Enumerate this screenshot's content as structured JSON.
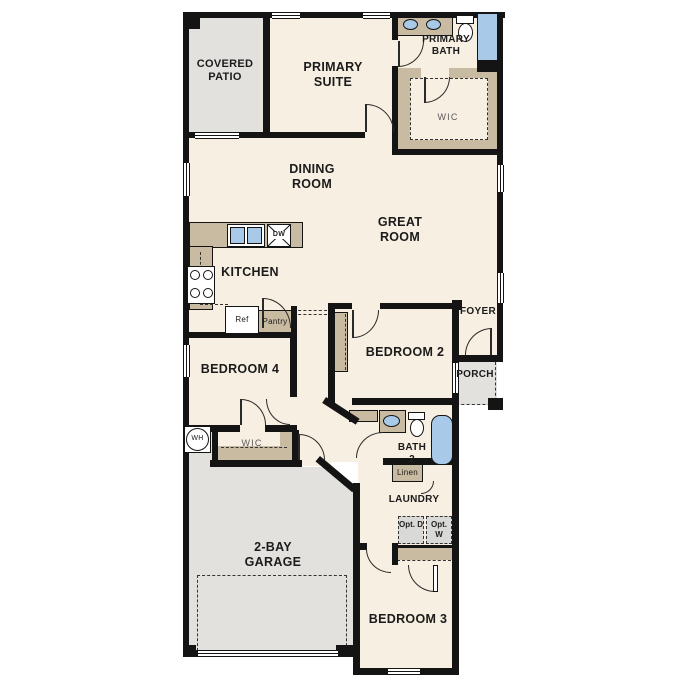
{
  "plan_title": "Single-story floor plan",
  "colors": {
    "wall": "#141414",
    "floor": "#f7efe1",
    "outdoor": "#e2e1de",
    "cabinet_tan": "#c8bba2",
    "fixture_blue": "#a9c9e9"
  },
  "rooms": {
    "covered_patio": "COVERED PATIO",
    "primary_suite": "PRIMARY SUITE",
    "primary_bath": "PRIMARY BATH",
    "primary_wic": "WIC",
    "dining_room": "DINING ROOM",
    "great_room": "GREAT ROOM",
    "kitchen": "KITCHEN",
    "foyer": "FOYER",
    "porch": "PORCH",
    "bedroom_2": "BEDROOM 2",
    "bedroom_4": "BEDROOM 4",
    "bedroom_4_wic": "WIC",
    "bath_2": "BATH 2",
    "laundry": "LAUNDRY",
    "garage": "2-BAY GARAGE",
    "bedroom_3": "BEDROOM 3"
  },
  "fixtures": {
    "ref": "Ref",
    "pantry": "Pantry",
    "dw": "DW",
    "linen": "Linen",
    "wh": "WH",
    "opt_dryer": "Opt. D",
    "opt_washer": "Opt. W"
  }
}
